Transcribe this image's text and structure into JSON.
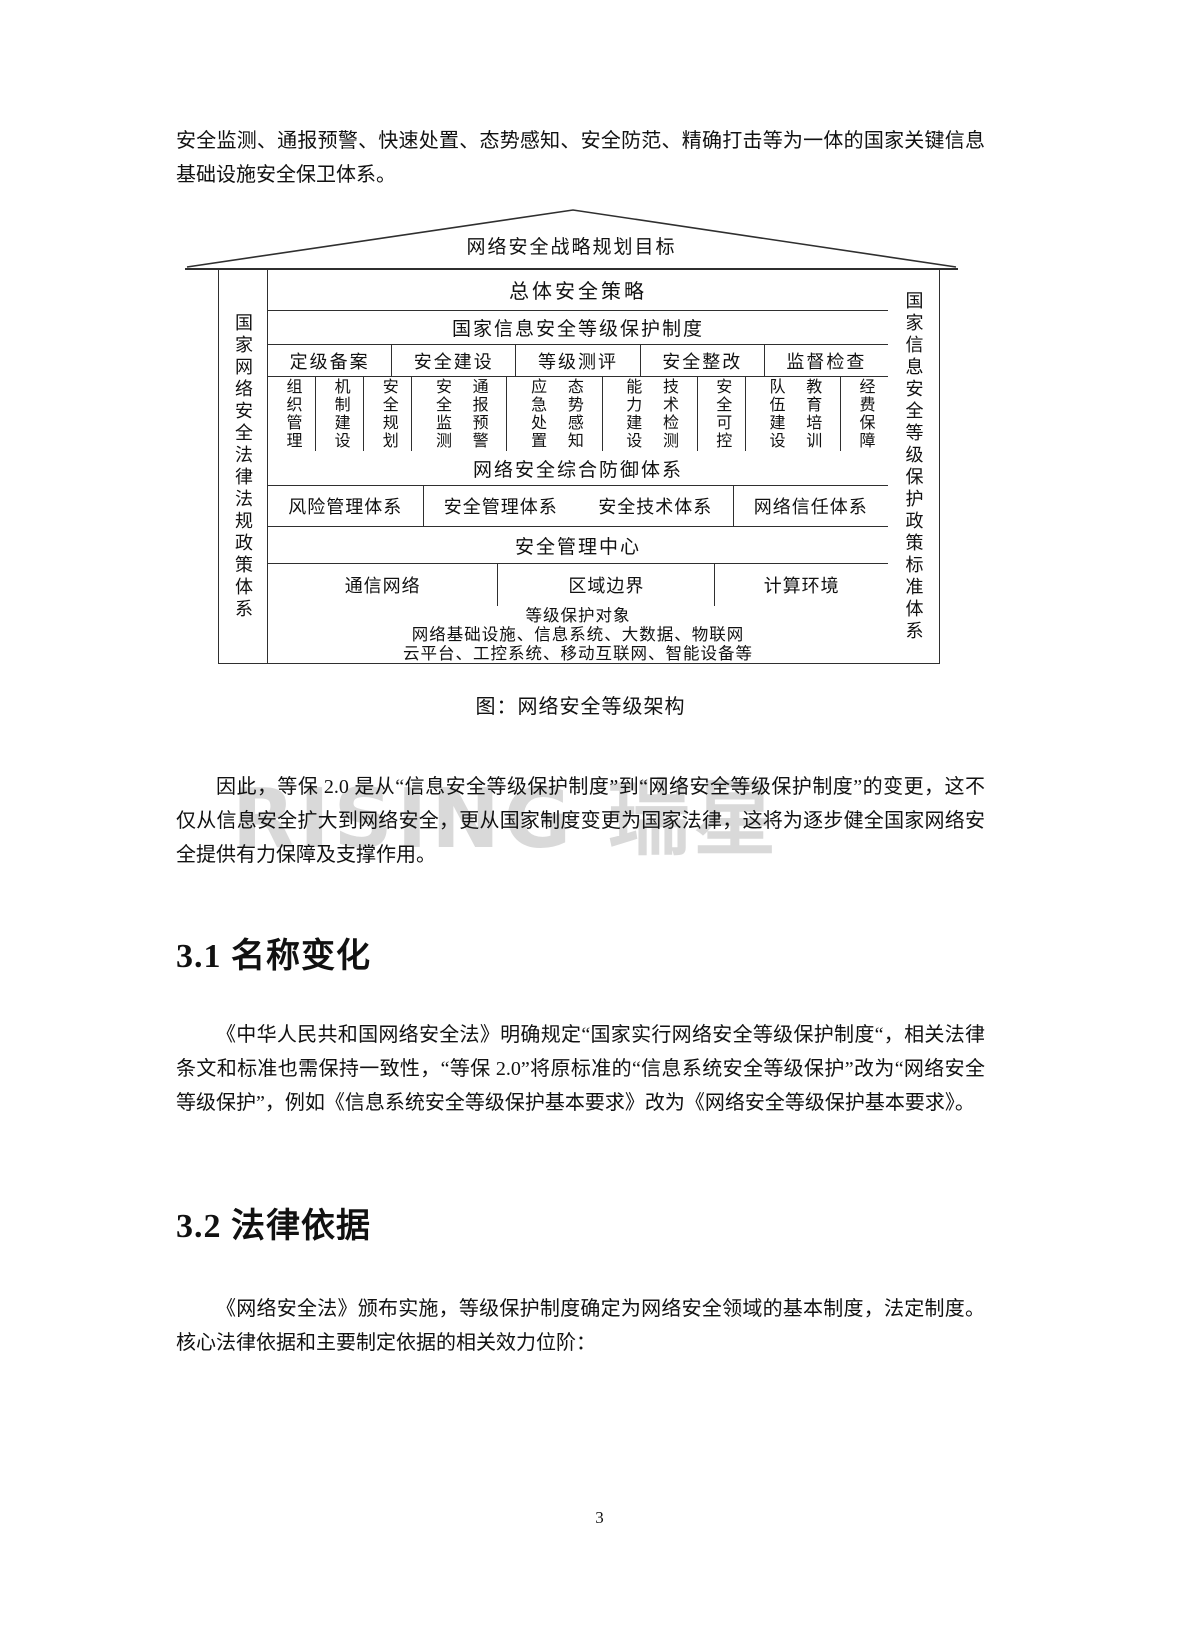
{
  "page": {
    "number": "3",
    "watermark_text": "RISING 瑞星"
  },
  "colors": {
    "diagram_line": "#2f2f2f",
    "watermark": "#d9d9d9",
    "text": "#111111"
  },
  "headings": {
    "s31": "3.1 名称变化",
    "s32": "3.2 法律依据"
  },
  "paragraphs": {
    "intro": "安全监测、通报预警、快速处置、态势感知、安全防范、精确打击等为一体的国家关键信息基础设施安全保卫体系。",
    "after_figure": "因此，等保 2.0 是从“信息安全等级保护制度”到“网络安全等级保护制度”的变更，这不仅从信息安全扩大到网络安全，更从国家制度变更为国家法律，这将为逐步健全国家网络安全提供有力保障及支撑作用。",
    "section31_body": "《中华人民共和国网络安全法》明确规定“国家实行网络安全等级保护制度“，相关法律条文和标准也需保持一致性，“等保 2.0”将原标准的“信息系统安全等级保护”改为“网络安全等级保护”，例如《信息系统安全等级保护基本要求》改为《网络安全等级保护基本要求》。",
    "section32_body": "《网络安全法》颁布实施，等级保护制度确定为网络安全领域的基本制度，法定制度。核心法律依据和主要制定依据的相关效力位阶："
  },
  "figure": {
    "caption": "图：网络安全等级架构",
    "roof": "网络安全战略规划目标",
    "left_pillar": "国家网络安全法律法规政策体系",
    "right_pillar": "国家信息安全等级保护政策标准体系",
    "row1": "总体安全策略",
    "row2": "国家信息安全等级保护制度",
    "process": [
      "定级备案",
      "安全建设",
      "等级测评",
      "安全整改",
      "监督检查"
    ],
    "columns": [
      {
        "items": [
          "组织管理"
        ]
      },
      {
        "items": [
          "机制建设"
        ]
      },
      {
        "items": [
          "安全规划"
        ]
      },
      {
        "items": [
          "安全监测",
          "通报预警"
        ]
      },
      {
        "items": [
          "应急处置",
          "态势感知"
        ]
      },
      {
        "items": [
          "能力建设",
          "技术检测"
        ]
      },
      {
        "items": [
          "安全可控"
        ]
      },
      {
        "items": [
          "队伍建设",
          "教育培训"
        ]
      },
      {
        "items": [
          "经费保障"
        ]
      }
    ],
    "defense": "网络安全综合防御体系",
    "systems": [
      "风险管理体系",
      "安全管理体系",
      "安全技术体系",
      "网络信任体系"
    ],
    "mgmt_center": "安全管理中心",
    "environments": [
      "通信网络",
      "区域边界",
      "计算环境"
    ],
    "objects_title": "等级保护对象",
    "objects_line1": "网络基础设施、信息系统、大数据、物联网",
    "objects_line2": "云平台、工控系统、移动互联网、智能设备等"
  }
}
